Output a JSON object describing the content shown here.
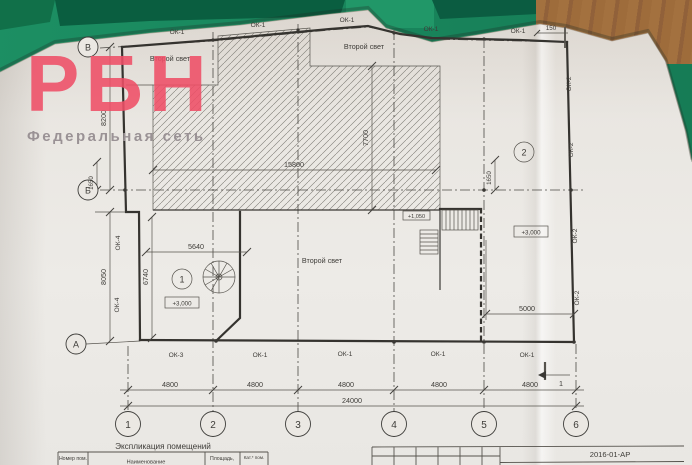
{
  "colors": {
    "desk_green": "#17845c",
    "wood_brown": "#9c6b3e",
    "paper": "#eae7e2",
    "logo_pink": "#ef4f67",
    "tagline_gray": "#9a9295",
    "line_ink": "#35332f"
  },
  "watermark": {
    "logo": "РБН",
    "tagline": "Федеральная сеть"
  },
  "plan": {
    "grid": {
      "columns": [
        "1",
        "2",
        "3",
        "4",
        "5",
        "6"
      ],
      "rows": [
        "В",
        "Б",
        "А"
      ]
    },
    "window_marks": {
      "top": [
        "ОК-1",
        "ОК-1",
        "ОК-1",
        "ОК-1",
        "ОК-1"
      ],
      "bottom": [
        "ОК-3",
        "ОК-1",
        "ОК-1",
        "ОК-1",
        "ОК-1"
      ],
      "right": [
        "ОК-2",
        "ОК-2",
        "ОК-2",
        "ОК-2"
      ],
      "left": [
        "ОК-4",
        "ОК-4"
      ]
    },
    "second_light_labels": [
      "Второй свет",
      "Второй свет",
      "Второй свет"
    ],
    "rooms": [
      {
        "number": "1",
        "elevation": "+3,000"
      },
      {
        "number": "2",
        "elevation": "+3,000"
      }
    ],
    "stair_elevation": "+1,050",
    "dims": {
      "spans": [
        "4800",
        "4800",
        "4800",
        "4800",
        "4800"
      ],
      "total": "24000",
      "left_upper": "8200",
      "left_b_offset": "1650",
      "left_lower": "8050",
      "room1_height": "6740",
      "room1_width": "5640",
      "opening_width": "15800",
      "opening_height": "7700",
      "axis5_offset": "1650",
      "room2_width": "5000",
      "top_right": "150"
    },
    "section_mark": "1"
  },
  "titleblock": {
    "sheet_code": "2016-01-АР"
  },
  "schedule": {
    "title": "Экспликация помещений",
    "headers": [
      "Номер пом.",
      "Наименование",
      "Площадь,",
      "Кат.* пом."
    ]
  }
}
